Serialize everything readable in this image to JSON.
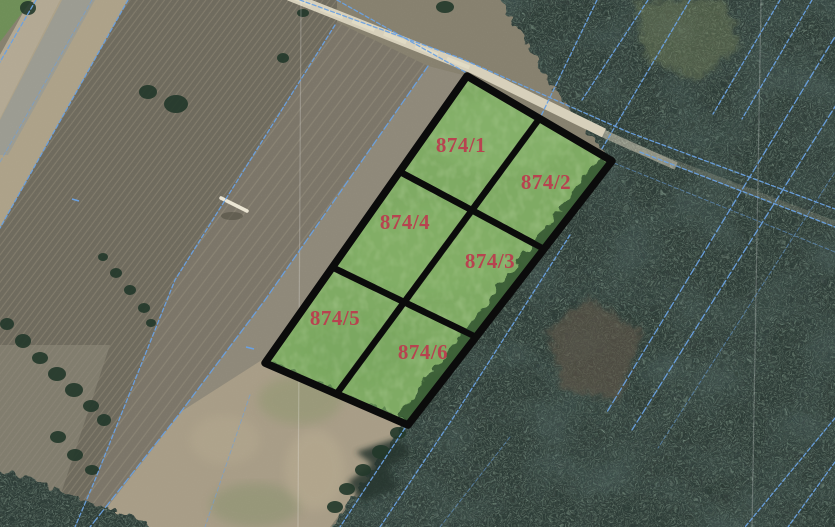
{
  "map": {
    "view": "aerial-orthophoto-cadastral",
    "colors": {
      "parcel_fill": "#7fab64",
      "parcel_outline": "#0b0b0b",
      "parcel_label": "#bc3b4e",
      "boundary_line": "#6aa1e2",
      "road_fill": "#d7d0bb"
    },
    "block_outline_points": "467,76 612,161 408,425 265,363",
    "parcels": [
      {
        "id": "874/1",
        "label": "874/1",
        "points": "467,76 539.5,118.5 471.9,210.3 399.7,171.7",
        "label_x": 461,
        "label_y": 152
      },
      {
        "id": "874/2",
        "label": "874/2",
        "points": "539.5,118.5 612,161 544,249 471.9,210.3",
        "label_x": 546,
        "label_y": 189
      },
      {
        "id": "874/3",
        "label": "874/3",
        "points": "471.9,210.3 544,249 476,337 404.2,302.2",
        "label_x": 490,
        "label_y": 268
      },
      {
        "id": "874/4",
        "label": "874/4",
        "points": "399.7,171.7 471.9,210.3 404.2,302.2 332.3,267.3",
        "label_x": 405,
        "label_y": 229
      },
      {
        "id": "874/5",
        "label": "874/5",
        "points": "332.3,267.3 404.2,302.2 336.5,394 265,363",
        "label_x": 335,
        "label_y": 325
      },
      {
        "id": "874/6",
        "label": "874/6",
        "points": "404.2,302.2 476,337 408,425 336.5,394",
        "label_x": 423,
        "label_y": 359
      }
    ]
  }
}
